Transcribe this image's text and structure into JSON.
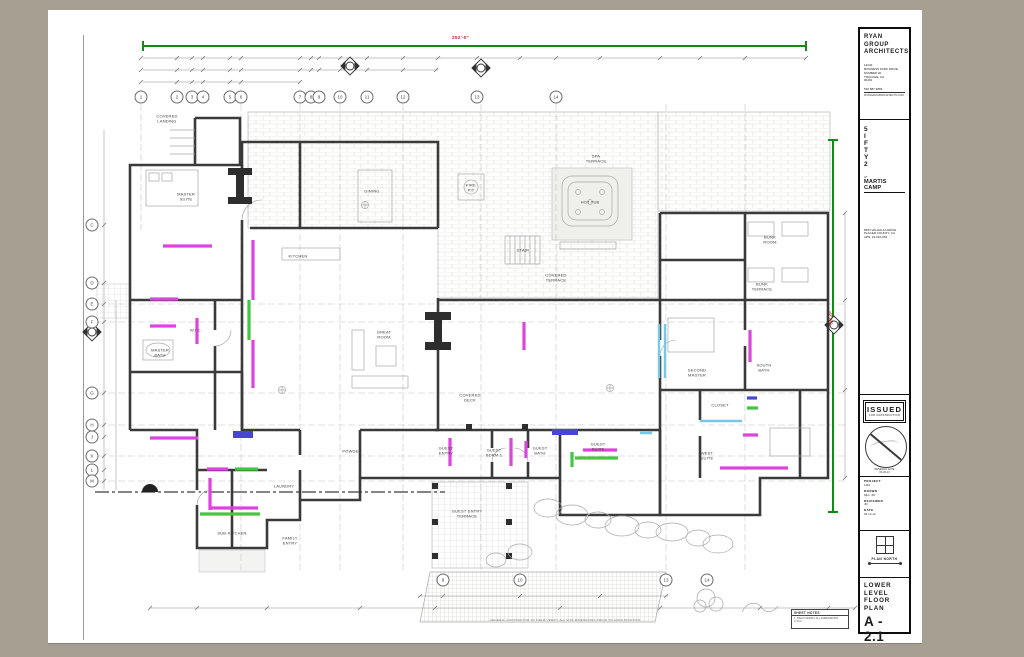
{
  "page": {
    "background": "#a79f92",
    "sheet_color": "#ffffff"
  },
  "title_block": {
    "firm": {
      "name_lines": [
        "RYAN",
        "GROUP",
        "ARCHITECTS"
      ],
      "address_lines": [
        "12242",
        "BUSINESS PARK DRIVE",
        "NUMBER 20",
        "TRUCKEE, CA",
        "96161"
      ],
      "phone": "530 587 3866",
      "web": "RYANGROUPARCHITECTS.COM"
    },
    "project": {
      "letters": [
        "5",
        "I",
        "F",
        "T",
        "Y",
        "2"
      ],
      "at": "AT",
      "community": "MARTIS CAMP",
      "address_lines": [
        "8354 VALHALLA DRIVE",
        "PLACER COUNTY, CA",
        "APN: 19-010-052"
      ]
    },
    "issued": {
      "label": "ISSUED",
      "sub": "FOR CONSTRUCTION"
    },
    "stamp": {
      "lines": [
        "RENEWAL DATE",
        "06-30-13"
      ]
    },
    "fields": [
      {
        "label": "PROJECT",
        "value": "1110"
      },
      {
        "label": "DRAWN",
        "value": "MH / JR"
      },
      {
        "label": "REVIEWED",
        "value": "JR"
      },
      {
        "label": "DATE",
        "value": "05.14.12"
      }
    ],
    "plan_north_label": "PLAN NORTH",
    "sheet_title_lines": [
      "LOWER",
      "LEVEL",
      "FLOOR",
      "PLAN"
    ],
    "sheet_number": "A - 2.1"
  },
  "plan": {
    "top_dimension": "252'-0\"",
    "right_dimension": "86'-0\"",
    "grid_top": [
      {
        "n": "1",
        "x": 141
      },
      {
        "n": "2",
        "x": 177
      },
      {
        "n": "3",
        "x": 192
      },
      {
        "n": "4",
        "x": 203
      },
      {
        "n": "5",
        "x": 230
      },
      {
        "n": "6",
        "x": 241
      },
      {
        "n": "7",
        "x": 300
      },
      {
        "n": "8",
        "x": 311
      },
      {
        "n": "9",
        "x": 319
      },
      {
        "n": "10",
        "x": 340
      },
      {
        "n": "11",
        "x": 367
      },
      {
        "n": "12",
        "x": 403
      },
      {
        "n": "13",
        "x": 477
      },
      {
        "n": "14",
        "x": 556
      }
    ],
    "grid_bottom": [
      {
        "n": "8",
        "x": 443
      },
      {
        "n": "10",
        "x": 520
      },
      {
        "n": "13",
        "x": 666
      },
      {
        "n": "14",
        "x": 707
      }
    ],
    "grid_left": [
      {
        "n": "C",
        "y": 225
      },
      {
        "n": "D",
        "y": 283
      },
      {
        "n": "E",
        "y": 304
      },
      {
        "n": "F",
        "y": 322
      },
      {
        "n": "G",
        "y": 393
      },
      {
        "n": "H",
        "y": 425
      },
      {
        "n": "J",
        "y": 437
      },
      {
        "n": "K",
        "y": 456
      },
      {
        "n": "L",
        "y": 470
      },
      {
        "n": "M",
        "y": 481
      }
    ],
    "room_labels": [
      {
        "t": "COVERED|LANDING",
        "x": 167,
        "y": 119
      },
      {
        "t": "MASTER|SUITE",
        "x": 186,
        "y": 197
      },
      {
        "t": "MASTER|BATH",
        "x": 160,
        "y": 353
      },
      {
        "t": "W.I.C.",
        "x": 196,
        "y": 331
      },
      {
        "t": "KITCHEN",
        "x": 298,
        "y": 257
      },
      {
        "t": "DINING",
        "x": 372,
        "y": 192
      },
      {
        "t": "GREAT|ROOM",
        "x": 384,
        "y": 335
      },
      {
        "t": "STAIR",
        "x": 523,
        "y": 251
      },
      {
        "t": "COVERED|TERRACE",
        "x": 556,
        "y": 278
      },
      {
        "t": "SPA|TERRACE",
        "x": 596,
        "y": 159
      },
      {
        "t": "HOT TUB",
        "x": 590,
        "y": 203
      },
      {
        "t": "FIRE|PIT",
        "x": 471,
        "y": 188
      },
      {
        "t": "COVERED|DECK",
        "x": 470,
        "y": 398
      },
      {
        "t": "LAUNDRY",
        "x": 284,
        "y": 487
      },
      {
        "t": "SUB-KITCHEN",
        "x": 232,
        "y": 534
      },
      {
        "t": "FAMILY|ENTRY",
        "x": 290,
        "y": 541
      },
      {
        "t": "POWDER",
        "x": 352,
        "y": 452
      },
      {
        "t": "GUEST|ENTRY",
        "x": 446,
        "y": 451
      },
      {
        "t": "GUEST|BDRM 1",
        "x": 494,
        "y": 453
      },
      {
        "t": "GUEST|BATH",
        "x": 540,
        "y": 451
      },
      {
        "t": "GUEST|SUITE",
        "x": 598,
        "y": 447
      },
      {
        "t": "GUEST ENTRY|TERRACE",
        "x": 467,
        "y": 514
      },
      {
        "t": "SECOND|MASTER",
        "x": 697,
        "y": 373
      },
      {
        "t": "CLOSET",
        "x": 720,
        "y": 406
      },
      {
        "t": "SOUTH|BATH",
        "x": 764,
        "y": 368
      },
      {
        "t": "WEST|SUITE",
        "x": 707,
        "y": 456
      },
      {
        "t": "BUNK|ROOM",
        "x": 770,
        "y": 240
      },
      {
        "t": "BUNK|TERRACE",
        "x": 762,
        "y": 287
      }
    ],
    "notes": {
      "title": "SHEET NOTES",
      "line": "1. FIELD VERIFY ALL DIMENSIONS U.N.O."
    },
    "bottom_note": "GENERAL CONTRACTOR TO FIELD VERIFY ALL SITE DIMENSIONS PRIOR TO CONSTRUCTION",
    "colors": {
      "wall": "#3a3a3a",
      "highlight_magenta": "#dd44dd",
      "highlight_green": "#44c544",
      "highlight_cyan": "#79c7e8",
      "highlight_blue": "#4646d2",
      "dimension_green": "#128c12",
      "dimension_red": "#cc2222"
    }
  }
}
